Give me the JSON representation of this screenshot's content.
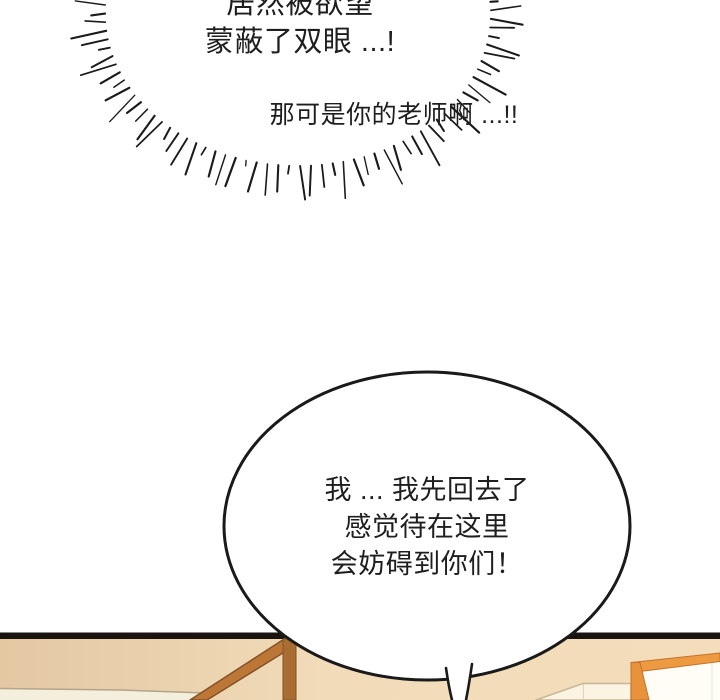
{
  "page": {
    "background": "#ffffff"
  },
  "burst_bubble": {
    "line1": "居然被欲望",
    "line2": "蒙蔽了双眼 ...!",
    "line3": "那可是你的老师啊 ...!!",
    "ink_color": "#1b1b1b",
    "shape": {
      "cx": 298,
      "cy": 14,
      "rx": 193,
      "ry": 152,
      "angle_start": -50,
      "angle_end": 232,
      "count": 88,
      "min_len": 9,
      "len_var": 26
    }
  },
  "speech_bubble": {
    "line1": "我 ... 我先回去了",
    "line2": "感觉待在这里",
    "line3": "会妨碍到你们！",
    "fill": "#ffffff",
    "stroke": "#1a1a1a"
  },
  "scene": {
    "wall_top_line_color": "#1a1410",
    "wall_color_left": "#e3c8a2",
    "wall_color_right": "#f3ddbb",
    "baseboard_color": "#f4eedd",
    "beam_color": "#bc7737",
    "beam_edge_color": "#83522a",
    "post_color": "#a96c31",
    "picture_frame_color": "#ee9a41",
    "picture_frame_edge_color": "#c3722d",
    "picture_frame_inner_color": "#fffdf6",
    "box_color": "#fbf4e3",
    "box_edge_color": "#c9b795"
  }
}
